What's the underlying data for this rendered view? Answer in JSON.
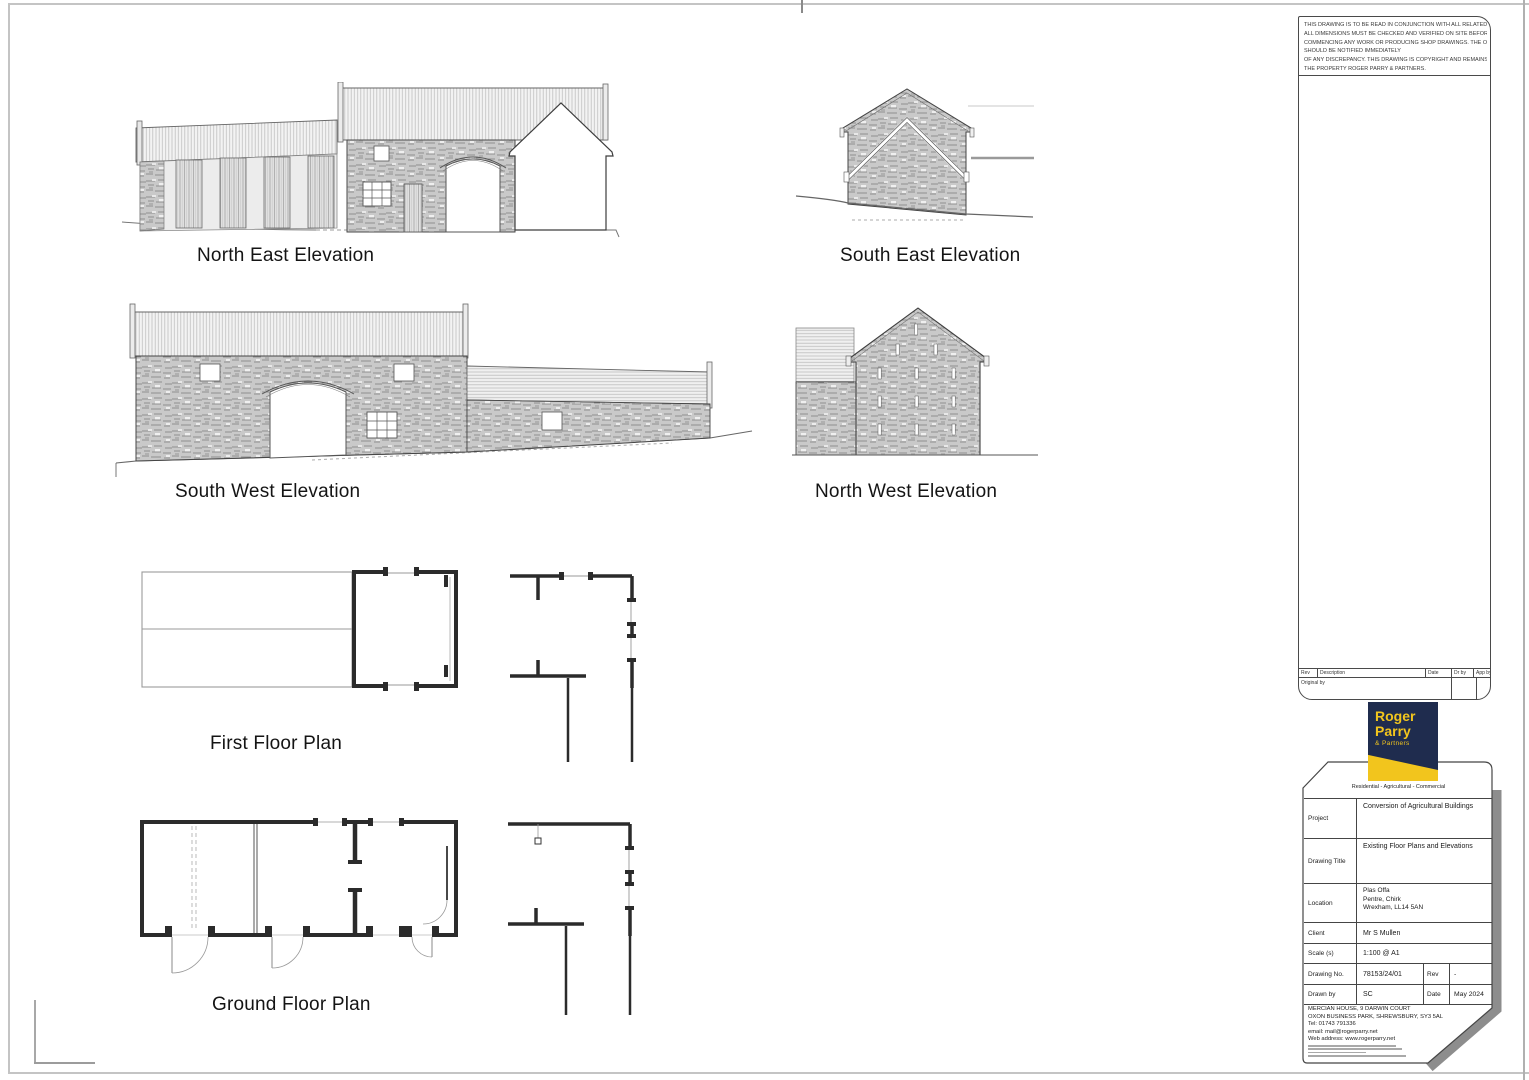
{
  "sheet": {
    "notes": [
      "THIS DRAWING IS TO BE READ IN CONJUNCTION WITH ALL RELATED DRAWINGS.",
      "ALL DIMENSIONS MUST BE CHECKED AND VERIFIED ON SITE BEFORE",
      "COMMENCING ANY WORK OR PRODUCING SHOP DRAWINGS. THE ORIGINATOR",
      "SHOULD BE NOTIFIED IMMEDIATELY",
      "OF ANY DISCREPANCY. THIS DRAWING IS COPYRIGHT AND REMAINS",
      "THE PROPERTY ROGER PARRY & PARTNERS."
    ]
  },
  "drawings": {
    "north_east_label": "North East Elevation",
    "south_east_label": "South East Elevation",
    "south_west_label": "South West Elevation",
    "north_west_label": "North West Elevation",
    "first_floor_label": "First Floor Plan",
    "ground_floor_label": "Ground Floor Plan"
  },
  "revision_table": {
    "rev": "Rev",
    "description": "Description",
    "date": "Date",
    "dr_by": "Dr by",
    "app_by": "App by",
    "original_by": "Original by"
  },
  "logo": {
    "word1": "Roger",
    "word2": "Parry",
    "word3": "& Partners",
    "tagline": "Residential - Agricultural - Commercial",
    "navy": "#1f2c4e",
    "yellow": "#f2c51d"
  },
  "title_block": {
    "project_label": "Project",
    "project_value": "Conversion of Agricultural Buildings",
    "drawing_title_label": "Drawing Title",
    "drawing_title_value": "Existing Floor Plans and Elevations",
    "location_label": "Location",
    "location_line1": "Plas Offa",
    "location_line2": "Pentre, Chirk",
    "location_line3": "Wrexham, LL14 5AN",
    "client_label": "Client",
    "client_value": "Mr S Mullen",
    "scale_label": "Scale (s)",
    "scale_value": "1:100 @ A1",
    "drawing_no_label": "Drawing No.",
    "drawing_no_value": "78153/24/01",
    "rev_label": "Rev",
    "rev_value": "-",
    "drawn_by_label": "Drawn by",
    "drawn_by_value": "SC",
    "date_label": "Date",
    "date_value": "May 2024"
  },
  "address": {
    "line1": "MERCIAN HOUSE, 9 DARWIN COURT",
    "line2": "OXON BUSINESS PARK, SHREWSBURY, SY3 5AL",
    "line3": "Tel: 01743 791336",
    "line4": "email: mail@rogerparry.net",
    "line5": "Web address: www.rogerparry.net"
  }
}
